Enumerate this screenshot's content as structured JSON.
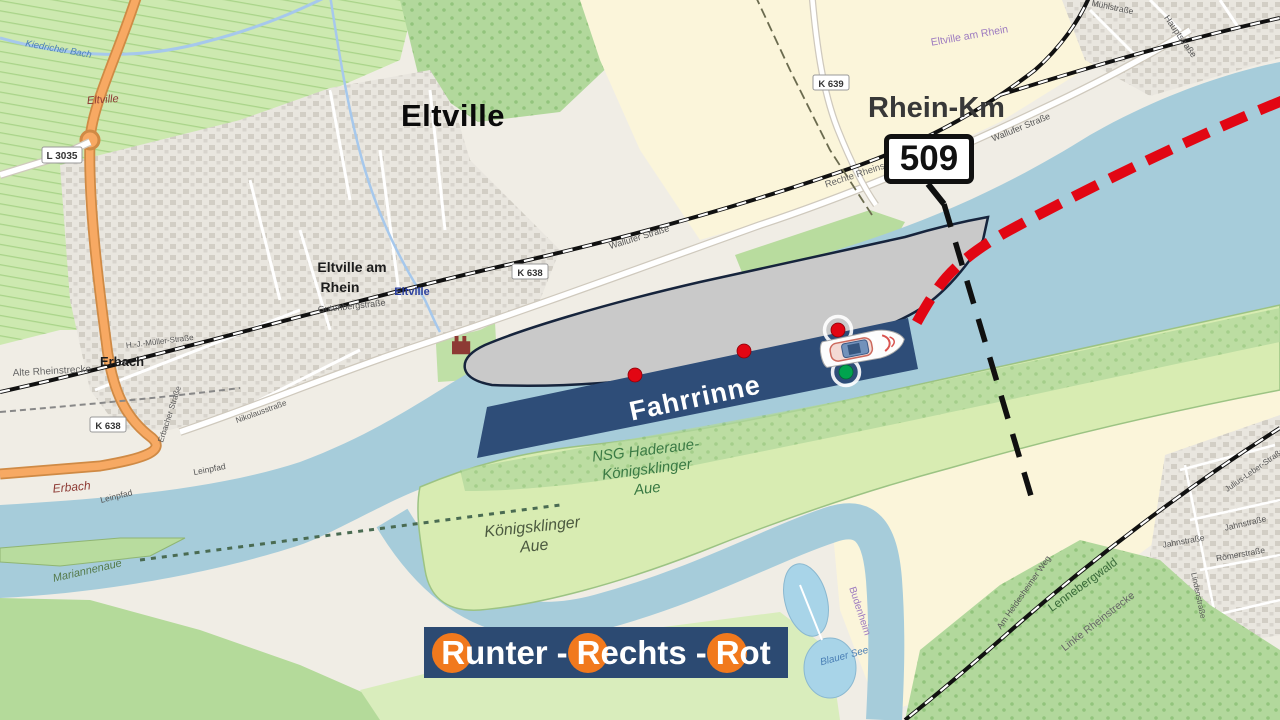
{
  "annotations": {
    "city": "Eltville",
    "rhein_km": {
      "label": "Rhein-Km",
      "value": "509"
    },
    "fairway": "Fahrrinne",
    "banner": {
      "r1": "R",
      "w1": "unter",
      "sep1": "-",
      "r2": "R",
      "w2": "echts",
      "sep2": "-",
      "r3": "R",
      "w3": "ot"
    },
    "colors": {
      "fairway_band": "#2E4D78",
      "banner_bg": "#2C4A72",
      "banner_circle_orange": "#F1791D",
      "route_red": "#E20613",
      "buoy_red": "#E20613",
      "buoy_green": "#00A34E",
      "ship_gray": "#C9C9C9",
      "water_blue": "#A6CCDA",
      "km_line_black": "#101010"
    }
  },
  "map_labels": {
    "town_line1": "Eltville am",
    "town_line2": "Rhein",
    "station": "Eltville",
    "gutenbergstrasse": "Gutenbergstraße",
    "erbach": "Erbach",
    "erbach_vineyard": "Erbach",
    "eltville_vineyard": "Eltville",
    "kiedricher_bach": "Kiedricher Bach",
    "l3035": "L 3035",
    "k638": "K 638",
    "k639": "K 639",
    "wallufer_strasse": "Wallufer Straße",
    "rechte_rheinstrecke": "Rechte Rheinstrecke",
    "alte_rheinstrecke": "Alte Rheinstrecke",
    "linke_rheinstrecke": "Linke Rheinstrecke",
    "hj_mueller_strasse": "H.-J.-Müller-Straße",
    "erbacher_strasse": "Erbacher Straße",
    "nikolausstrasse": "Nikolausstraße",
    "leinpfad": "Leinpfad",
    "nsg_line1": "NSG Haderaue-",
    "nsg_line2": "Königsklinger",
    "nsg_line3": "Aue",
    "aue_line1": "Königsklinger",
    "aue_line2": "Aue",
    "mariannenaue": "Mariannenaue",
    "blauer_see": "Blauer See",
    "budenheim": "Budenheim",
    "lennebergwald": "Lennebergwald",
    "am_heidesheimer_weg": "Am Heidesheimer Weg",
    "jahnstrasse": "Jahnstraße",
    "roemerstrasse": "Römerstraße",
    "julius_leber_strasse": "Julius-Leber-Straße",
    "lindenstrasse": "Lindenstraße",
    "hauptstrasse": "Hauptstraße",
    "muehlstrasse": "Mühlstraße",
    "boundary": "Eltville am Rhein"
  }
}
